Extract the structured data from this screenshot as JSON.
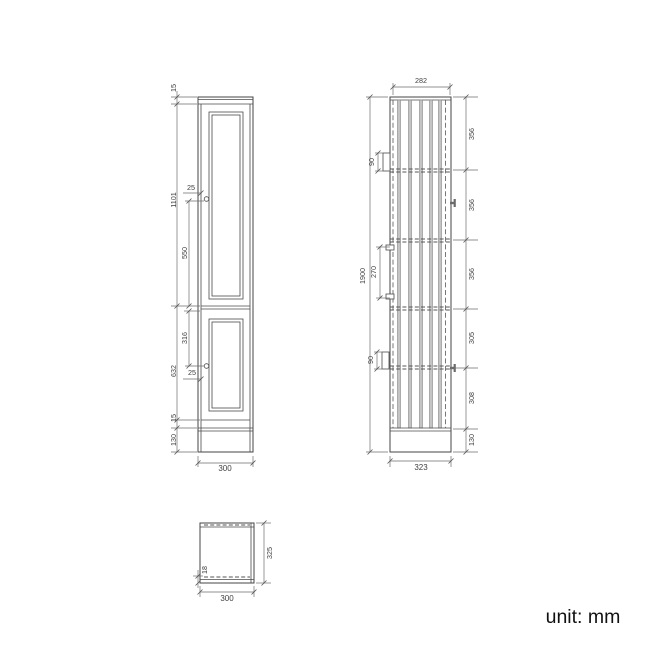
{
  "unit_label": "unit: mm",
  "colors": {
    "line": "#454545",
    "dimension_line": "#6e6e6e",
    "slat_fill": "#c4c4c4",
    "text": "#3f3f3f"
  },
  "front_view": {
    "top_overhang": "15",
    "upper_door_height": "1101",
    "upper_knob_inset": "25",
    "upper_knob_to_door_bottom": "550",
    "divider_to_lower_knob": "316",
    "lower_door_height": "632",
    "lower_knob_inset": "25",
    "bottom_gap": "15",
    "plinth_height": "130",
    "overall_width": "300"
  },
  "side_view": {
    "door_depth": "282",
    "overall_height": "1900",
    "upper_bracket_height": "90",
    "bracket_spacing": "270",
    "lower_bracket_height": "90",
    "segment_1": "356",
    "segment_2": "356",
    "segment_3": "356",
    "segment_4": "305",
    "segment_5": "308",
    "segment_6": "130",
    "overall_depth": "323"
  },
  "top_view": {
    "overall_depth": "325",
    "door_thickness": "18",
    "overall_width": "300"
  }
}
